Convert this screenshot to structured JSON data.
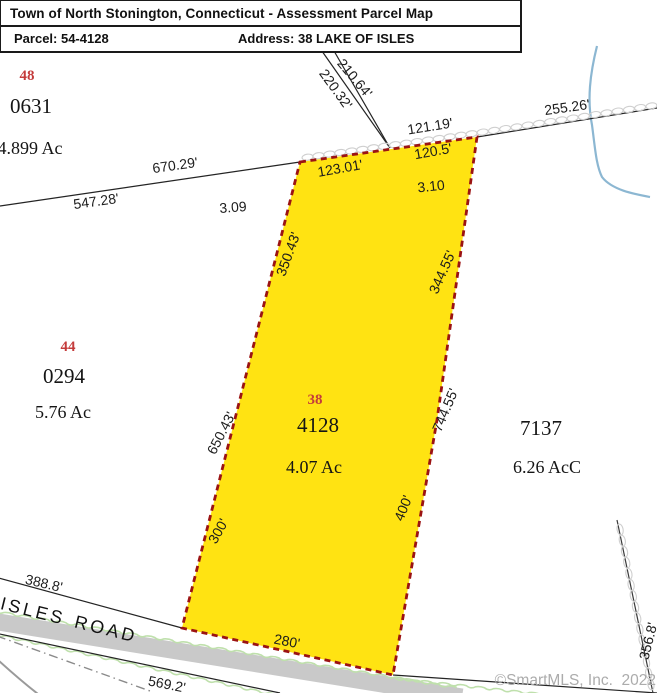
{
  "title_block": {
    "title": "Town of North Stonington, Connecticut - Assessment Parcel Map",
    "parcel_label": "Parcel: 54-4128",
    "address_label": "Address: 38 LAKE OF ISLES"
  },
  "watermark": "©SmartMLS, Inc.  2022",
  "colors": {
    "parcel_fill": "#FFE312",
    "parcel_border": "#9B1313",
    "lot_number": "#C43B3B",
    "stream": "#8CB7D2",
    "vegetation": "#BFE0AC",
    "road_fill": "#C9C9C9",
    "watermark": "#ACACAC"
  },
  "road": {
    "name_word1": "ISLES",
    "name_word2": "ROAD"
  },
  "parcels": [
    {
      "lot_number": "48",
      "parcel_id": "0631",
      "acreage": "4.899 Ac",
      "subject": false
    },
    {
      "lot_number": "44",
      "parcel_id": "0294",
      "acreage": "5.76 Ac",
      "subject": false
    },
    {
      "lot_number": "38",
      "parcel_id": "4128",
      "acreage": "4.07 Ac",
      "subject": true
    },
    {
      "parcel_id": "7137",
      "acreage": "6.26 AcC",
      "subject": false
    }
  ],
  "map_labels": [
    {
      "text": "210.64'",
      "x": 355,
      "y": 78,
      "rot": 50,
      "kind": "dimension"
    },
    {
      "text": "220.32'",
      "x": 336,
      "y": 89,
      "rot": 54,
      "kind": "dimension"
    },
    {
      "text": "255.26'",
      "x": 567,
      "y": 107,
      "rot": -8,
      "kind": "dimension"
    },
    {
      "text": "121.19'",
      "x": 430,
      "y": 126,
      "rot": -9,
      "kind": "dimension"
    },
    {
      "text": "120.5'",
      "x": 433,
      "y": 151,
      "rot": -10,
      "kind": "dimension"
    },
    {
      "text": "123.01'",
      "x": 340,
      "y": 168,
      "rot": -10,
      "kind": "dimension"
    },
    {
      "text": "3.10",
      "x": 431,
      "y": 186,
      "rot": -6,
      "kind": "dimension"
    },
    {
      "text": "670.29'",
      "x": 175,
      "y": 165,
      "rot": -8,
      "kind": "dimension"
    },
    {
      "text": "547.28'",
      "x": 96,
      "y": 201,
      "rot": -8,
      "kind": "dimension"
    },
    {
      "text": "3.09",
      "x": 233,
      "y": 207,
      "rot": -4,
      "kind": "dimension"
    },
    {
      "text": "350.43'",
      "x": 288,
      "y": 254,
      "rot": -70,
      "kind": "dimension"
    },
    {
      "text": "344.55'",
      "x": 442,
      "y": 272,
      "rot": -66,
      "kind": "dimension"
    },
    {
      "text": "650.43'",
      "x": 221,
      "y": 433,
      "rot": -63,
      "kind": "dimension"
    },
    {
      "text": "744.55'",
      "x": 445,
      "y": 410,
      "rot": -67,
      "kind": "dimension"
    },
    {
      "text": "300'",
      "x": 218,
      "y": 531,
      "rot": -61,
      "kind": "dimension"
    },
    {
      "text": "400'",
      "x": 403,
      "y": 508,
      "rot": -68,
      "kind": "dimension"
    },
    {
      "text": "388.8'",
      "x": 44,
      "y": 583,
      "rot": 13,
      "kind": "dimension"
    },
    {
      "text": "280'",
      "x": 287,
      "y": 641,
      "rot": 11,
      "kind": "dimension"
    },
    {
      "text": "569.2'",
      "x": 167,
      "y": 684,
      "rot": 11,
      "kind": "dimension"
    },
    {
      "text": "356.8'",
      "x": 648,
      "y": 641,
      "rot": -76,
      "kind": "dimension"
    },
    {
      "text": "ISLES",
      "x": 33,
      "y": 611,
      "rot": 14,
      "kind": "road-name"
    },
    {
      "text": "ROAD",
      "x": 106,
      "y": 629,
      "rot": 14,
      "kind": "road-name"
    },
    {
      "text": "48",
      "x": 27,
      "y": 76,
      "rot": 0,
      "kind": "lot-number"
    },
    {
      "text": "0631",
      "x": 31,
      "y": 106,
      "rot": 0,
      "kind": "parcel-id"
    },
    {
      "text": "4.899 Ac",
      "x": 30,
      "y": 148,
      "rot": 0,
      "kind": "acreage"
    },
    {
      "text": "44",
      "x": 68,
      "y": 347,
      "rot": 0,
      "kind": "lot-number"
    },
    {
      "text": "0294",
      "x": 64,
      "y": 376,
      "rot": 0,
      "kind": "parcel-id"
    },
    {
      "text": "5.76 Ac",
      "x": 63,
      "y": 412,
      "rot": 0,
      "kind": "acreage"
    },
    {
      "text": "38",
      "x": 315,
      "y": 400,
      "rot": 0,
      "kind": "lot-number"
    },
    {
      "text": "4128",
      "x": 318,
      "y": 425,
      "rot": 0,
      "kind": "parcel-id"
    },
    {
      "text": "4.07 Ac",
      "x": 314,
      "y": 467,
      "rot": 0,
      "kind": "acreage"
    },
    {
      "text": "7137",
      "x": 541,
      "y": 428,
      "rot": 0,
      "kind": "parcel-id"
    },
    {
      "text": "6.26 AcC",
      "x": 547,
      "y": 467,
      "rot": 0,
      "kind": "acreage"
    }
  ]
}
